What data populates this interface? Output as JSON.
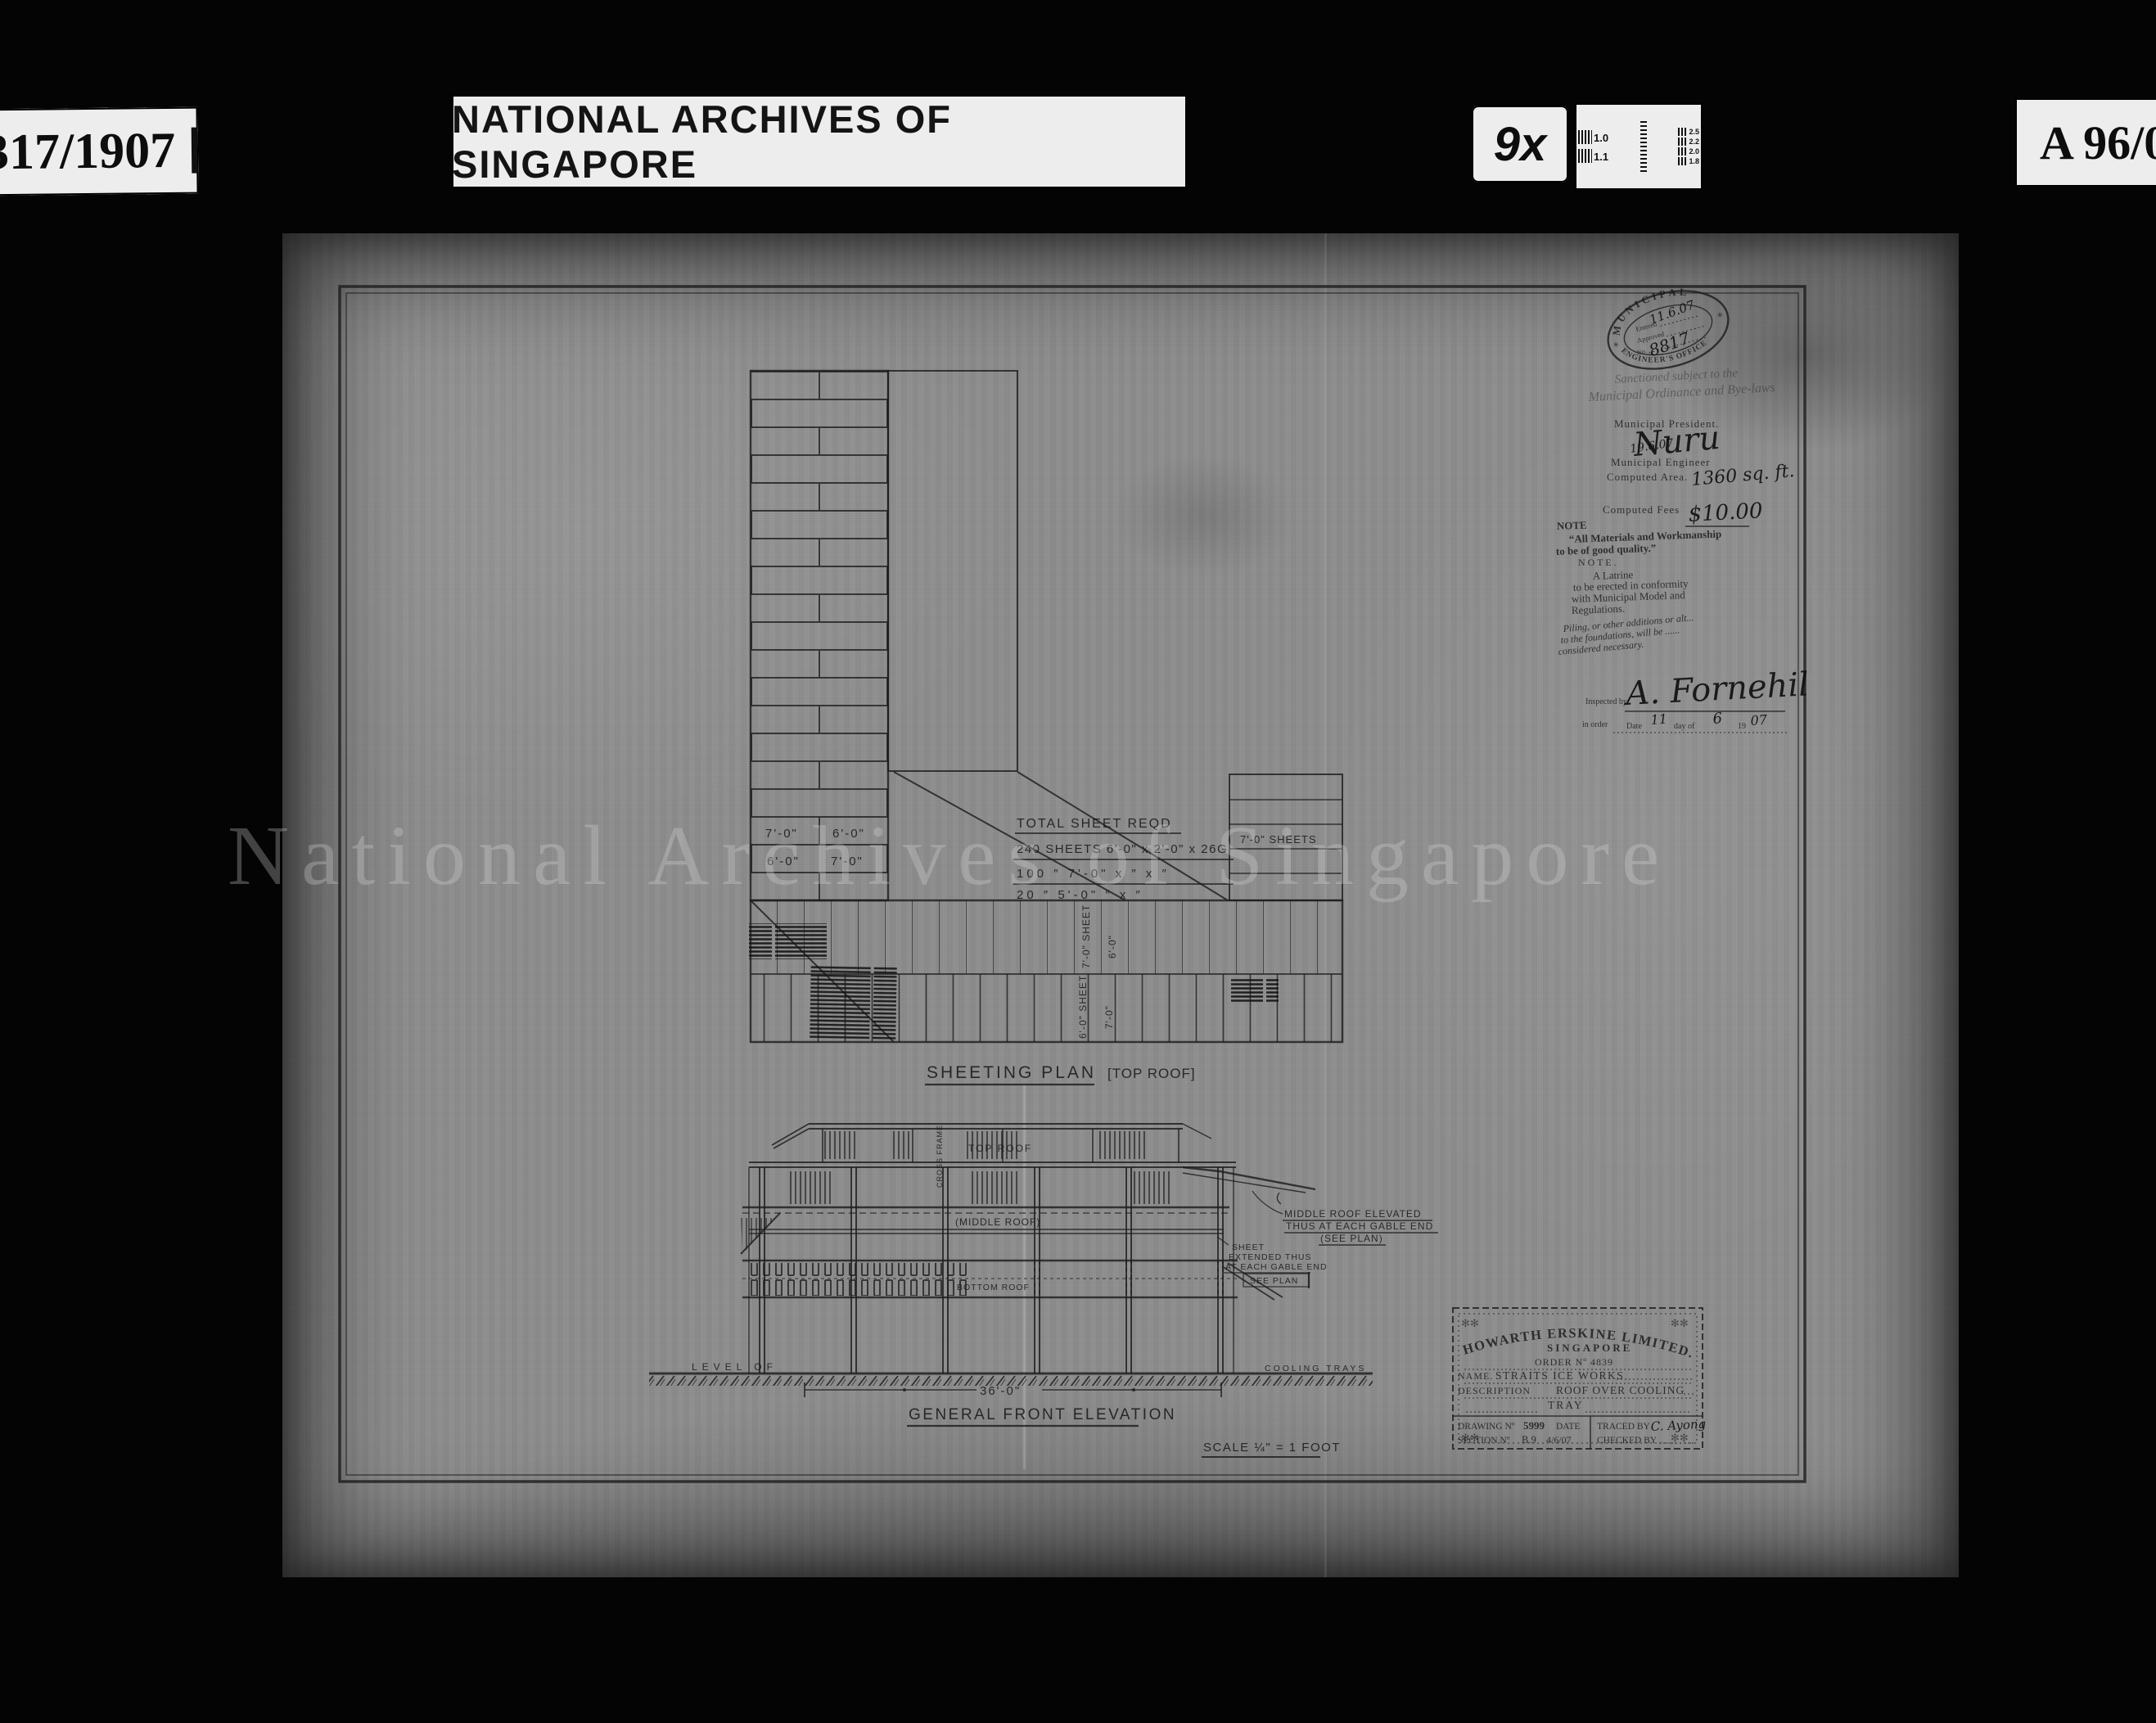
{
  "header": {
    "film_ref": "317/1907",
    "archive_title": "NATIONAL ARCHIVES OF SINGAPORE",
    "magnification": "9x",
    "shelf_ref": "A 96/0",
    "test_chart_labels": [
      "1.0",
      "1.1",
      "2.5",
      "2.2",
      "2.0",
      "1.8"
    ]
  },
  "watermark": "National Archives of Singapore",
  "stamp": {
    "ring_top": "MUNICIPAL",
    "ring_bottom": "ENGINEER'S OFFICE",
    "star": "✳",
    "entered_label": "Entered",
    "entered_value": "11.6.07",
    "approved_label": "Approved",
    "number_label": "No.",
    "number_value": "8817",
    "sanctioned_line1": "Sanctioned subject to the",
    "sanctioned_line2": "Municipal Ordinance and Bye-laws",
    "president_label": "Municipal President.",
    "president_signature": "Nuru",
    "engineer_label": "Municipal Engineer",
    "engineer_date": "19.6.07",
    "area_label": "Computed Area.",
    "area_value": "1360 sq. ft.",
    "fees_label": "Computed Fees",
    "fees_value": "$10.00",
    "note1_title": "NOTE",
    "note1_line1": "“All Materials and Workmanship",
    "note1_line2": "to be of good quality.”",
    "note2_title": "N O T E .",
    "note2_line1": "A  Latrine",
    "note2_line2": "to be erected in conformity",
    "note2_line3": "with Municipal Model and",
    "note2_line4": "Regulations.",
    "note3_line1": "Piling, or other additions or alt...",
    "note3_line2": "to the foundations, will be ......",
    "note3_line3": "considered necessary.",
    "inspected_label": "Inspected by",
    "inspected_signature": "A. Fornehil",
    "order_prefix": "in order",
    "order_date_label": "Date",
    "order_day": "11",
    "order_dayof": "day of",
    "order_month": "6",
    "order_19": "19",
    "order_year": "07"
  },
  "sheeting_plan": {
    "caption": "SHEETING PLAN",
    "caption_suffix": "[TOP ROOF]",
    "cells": {
      "r1c1": "7'-0\"",
      "r1c2": "6'-0\"",
      "r2c1": "6'-0\"",
      "r2c2": "7'-0\""
    },
    "schedule_title": "TOTAL SHEET REQD",
    "schedule_row1": "240 SHEETS 6'-0\" x 2'-0\" x 26G",
    "schedule_row2": "100 ″ 7'-0\" x ″ x ″",
    "schedule_row3": "20 ″ 5'-0\" ″ x ″",
    "right_table_label": "7'-0\" SHEETS",
    "v1": "7'-0\" SHEET",
    "v2": "6'-0\"",
    "v3": "6'-0\" SHEET",
    "v4": "7'-0\""
  },
  "elevation": {
    "caption": "GENERAL FRONT ELEVATION",
    "scale_label": "SCALE ¼\" = 1 FOOT",
    "top_roof": "TOP ROOF",
    "middle_roof": "(MIDDLE ROOF)",
    "bottom_roof": "BOTTOM ROOF",
    "cross_frame": "CROSS FRAME",
    "level_of": "LEVEL OF",
    "cooling_trays": "COOLING TRAYS",
    "dimension": "36'-0\"",
    "note_middle_1": "MIDDLE ROOF ELEVATED",
    "note_middle_2": "THUS AT EACH GABLE END",
    "note_middle_3": "(SEE PLAN)",
    "note_sheet_1": "SHEET",
    "note_sheet_2": "EXTENDED THUS",
    "note_sheet_3": "AT EACH GABLE END",
    "note_sheet_4": "SEE PLAN"
  },
  "title_block": {
    "company": "HOWARTH ERSKINE LIMITED.",
    "city": "SINGAPORE",
    "order": "ORDER Nº 4839",
    "name_label": "NAME.",
    "name_value": "STRAITS  ICE WORKS",
    "description_label": "DESCRIPTION",
    "description_value": "ROOF   OVER  COOLING",
    "description_value2": "TRAY",
    "drawing_label": "DRAWING Nº",
    "drawing_value": "5999",
    "date_label": "DATE",
    "date_value": "4/6/07",
    "traced_label": "TRACED BY",
    "traced_value": "C. Ayong",
    "section_label": "SECTION Nº",
    "section_value": "B.9",
    "checked_label": "CHECKED BY"
  }
}
